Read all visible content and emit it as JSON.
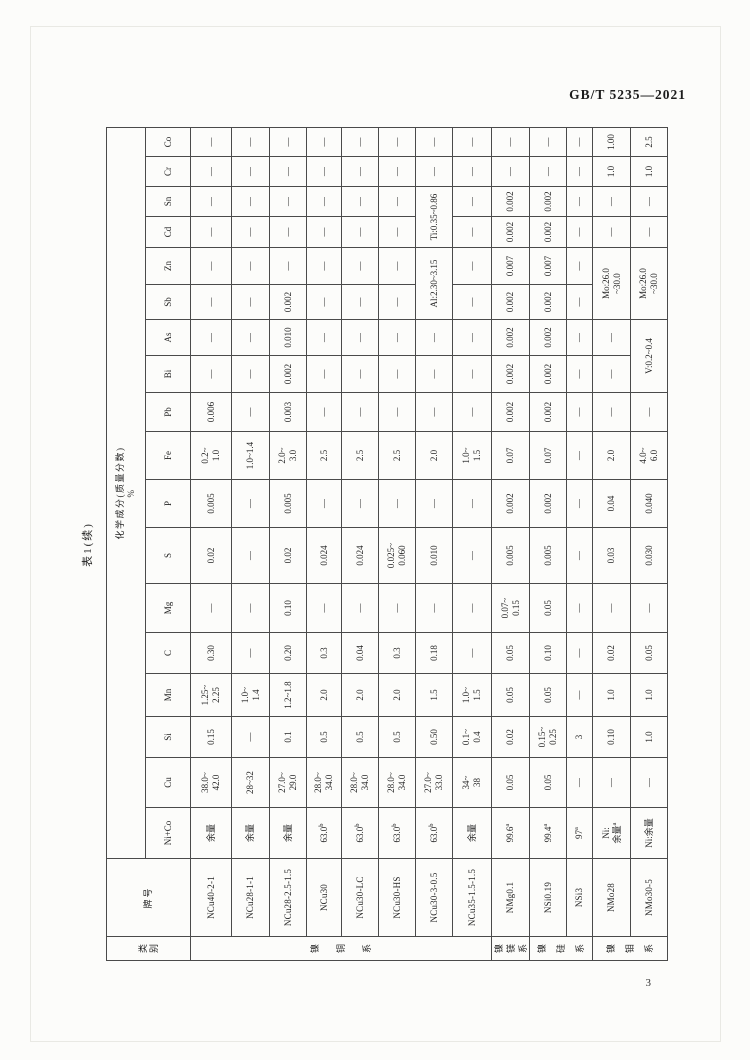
{
  "page": {
    "doc_number": "GB/T 5235—2021",
    "page_number": "3",
    "caption": "表1(续)"
  },
  "table": {
    "headers": {
      "category": "类\n别",
      "designation": "牌号",
      "composition": "化学成分(质量分数)\n%",
      "elements": [
        "Ni+Co",
        "Cu",
        "Si",
        "Mn",
        "C",
        "Mg",
        "S",
        "P",
        "Fe",
        "Pb",
        "Bi",
        "As",
        "Sb",
        "Zn",
        "Cd",
        "Sn",
        "Cr",
        "Co"
      ]
    },
    "categories": [
      {
        "label": "镍铜系",
        "span": 8
      },
      {
        "label": "镍镁系",
        "span": 1
      },
      {
        "label": "镍硅系",
        "span": 2
      },
      {
        "label": "镍钼系",
        "span": 2
      }
    ],
    "rows": [
      {
        "grade": "NCu40-2-1",
        "cells": [
          "余量",
          "38.0~\n42.0",
          "0.15",
          "1.25~\n2.25",
          "0.30",
          "—",
          "0.02",
          "0.005",
          "0.2~\n1.0",
          "0.006",
          "—",
          "—",
          "—",
          "—",
          "—",
          "—",
          "—",
          "—"
        ]
      },
      {
        "grade": "NCu28-1-1",
        "cells": [
          "余量",
          "28~32",
          "—",
          "1.0~\n1.4",
          "—",
          "—",
          "—",
          "—",
          "1.0~1.4",
          "—",
          "—",
          "—",
          "—",
          "—",
          "—",
          "—",
          "—",
          "—"
        ]
      },
      {
        "grade": "NCu28-2.5-1.5",
        "cells": [
          "余量",
          "27.0~\n29.0",
          "0.1",
          "1.2~1.8",
          "0.20",
          "0.10",
          "0.02",
          "0.005",
          "2.0~\n3.0",
          "0.003",
          "0.002",
          "0.010",
          "0.002",
          "—",
          "—",
          "—",
          "—",
          "—"
        ]
      },
      {
        "grade": "NCu30",
        "cells": [
          "63.0^b",
          "28.0~\n34.0",
          "0.5",
          "2.0",
          "0.3",
          "—",
          "0.024",
          "—",
          "2.5",
          "—",
          "—",
          "—",
          "—",
          "—",
          "—",
          "—",
          "—",
          "—"
        ]
      },
      {
        "grade": "NCu30-LC",
        "cells": [
          "63.0^b",
          "28.0~\n34.0",
          "0.5",
          "2.0",
          "0.04",
          "—",
          "0.024",
          "—",
          "2.5",
          "—",
          "—",
          "—",
          "—",
          "—",
          "—",
          "—",
          "—",
          "—"
        ]
      },
      {
        "grade": "NCu30-HS",
        "cells": [
          "63.0^b",
          "28.0~\n34.0",
          "0.5",
          "2.0",
          "0.3",
          "—",
          "0.025~\n0.060",
          "—",
          "2.5",
          "—",
          "—",
          "—",
          "—",
          "—",
          "—",
          "—",
          "—",
          "—"
        ]
      },
      {
        "grade": "NCu30-3-0.5",
        "cells": [
          "63.0^b",
          "27.0~\n33.0",
          "0.50",
          "1.5",
          "0.18",
          "—",
          "0.010",
          "—",
          "2.0",
          "—",
          "—",
          "—",
          {
            "text": "Al:2.30~3.15",
            "colspan": 2
          },
          {
            "text": "Ti:0.35~0.86",
            "colspan": 2
          },
          "—",
          "—"
        ]
      },
      {
        "grade": "NCu35-1.5-1.5",
        "cells": [
          "余量",
          "34~\n38",
          "0.1~\n0.4",
          "1.0~\n1.5",
          "—",
          "—",
          "—",
          "—",
          "1.0~\n1.5",
          "—",
          "—",
          "—",
          "—",
          "—",
          "—",
          "—",
          "—",
          "—"
        ]
      },
      {
        "grade": "NMg0.1",
        "cells": [
          "99.6^a",
          "0.05",
          "0.02",
          "0.05",
          "0.05",
          "0.07~\n0.15",
          "0.005",
          "0.002",
          "0.07",
          "0.002",
          "0.002",
          "0.002",
          "0.002",
          "0.007",
          "0.002",
          "0.002",
          "—",
          "—"
        ]
      },
      {
        "grade": "NSi0.19",
        "cells": [
          "99.4^a",
          "0.05",
          "0.15~\n0.25",
          "0.05",
          "0.10",
          "0.05",
          "0.005",
          "0.002",
          "0.07",
          "0.002",
          "0.002",
          "0.002",
          "0.002",
          "0.007",
          "0.002",
          "0.002",
          "—",
          "—"
        ]
      },
      {
        "grade": "NSi3",
        "cells": [
          "97^a",
          "—",
          "3",
          "—",
          "—",
          "—",
          "—",
          "—",
          "—",
          "—",
          "—",
          "—",
          "—",
          "—",
          "—",
          "—",
          "—",
          "—"
        ]
      },
      {
        "grade": "NMo28",
        "cells": [
          "Ni:\n余量^a",
          "—",
          "0.10",
          "1.0",
          "0.02",
          "—",
          "0.03",
          "0.04",
          "2.0",
          "—",
          "—",
          "—",
          {
            "text": "Mo:26.0\n~30.0",
            "colspan": 2
          },
          "—",
          "—",
          "1.0",
          "1.00"
        ]
      },
      {
        "grade": "NMo30-5",
        "cells": [
          "Ni:余量",
          "—",
          "1.0",
          "1.0",
          "0.05",
          "—",
          "0.030",
          "0.040",
          "4.0~\n6.0",
          "—",
          {
            "text": "V:0.2~0.4",
            "colspan": 2
          },
          {
            "text": "Mo:26.0\n~30.0",
            "colspan": 2
          },
          "—",
          "—",
          "1.0",
          "2.5"
        ]
      }
    ]
  }
}
